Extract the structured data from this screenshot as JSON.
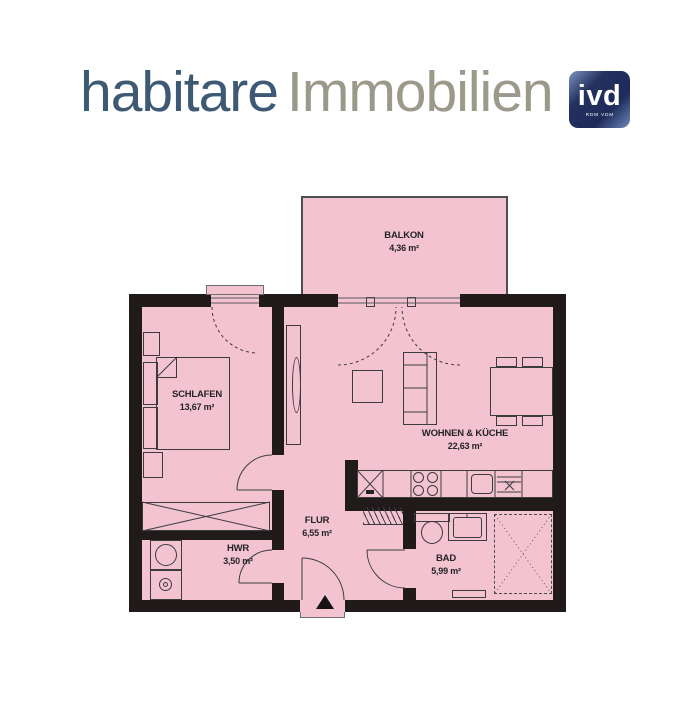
{
  "logo": {
    "brand": "habitare",
    "suffix": "Immobilien",
    "badge": {
      "text": "ivd",
      "subtext": "RDM VDM"
    },
    "colors": {
      "brand": "#3d5974",
      "suffix": "#9a998a",
      "badge_bg": "#1e2b5c"
    }
  },
  "floorplan": {
    "colors": {
      "floor_pink": "#f3c3d2",
      "wall_black": "#201a1b",
      "line": "#3c3c3c"
    },
    "rooms": {
      "balkon": {
        "name": "BALKON",
        "area": "4,36 m²"
      },
      "schlafen": {
        "name": "SCHLAFEN",
        "area": "13,67 m²"
      },
      "wohnen": {
        "name": "WOHNEN & KÜCHE",
        "area": "22,63 m²"
      },
      "flur": {
        "name": "FLUR",
        "area": "6,55 m²"
      },
      "hwr": {
        "name": "HWR",
        "area": "3,50 m²"
      },
      "bad": {
        "name": "BAD",
        "area": "5,99 m²"
      }
    }
  }
}
